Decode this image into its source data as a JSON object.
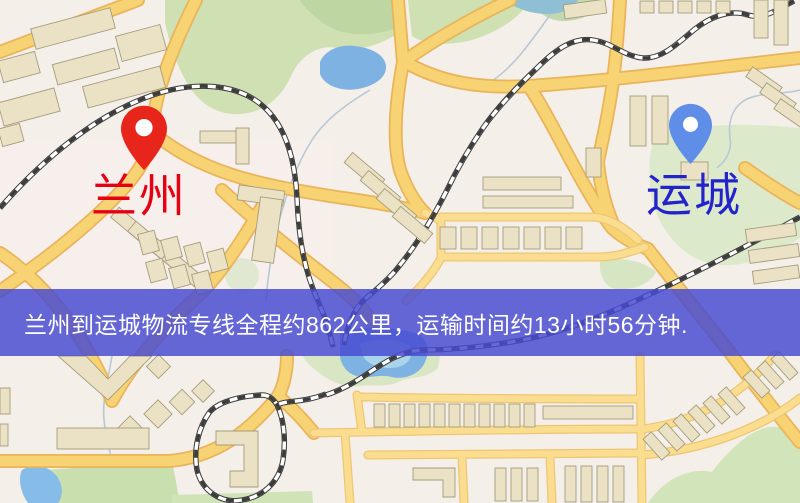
{
  "map": {
    "origin": {
      "label": "兰州",
      "pin_color": "#e8251b",
      "label_color": "#e60012"
    },
    "destination": {
      "label": "运城",
      "pin_color": "#5f8ee8",
      "label_color": "#2323cc"
    },
    "banner": {
      "text": "兰州到运城物流专线全程约862公里，运输时间约13小时56分钟.",
      "background_color": "rgba(72,75,210,0.84)",
      "text_color": "#ffffff",
      "distance_km": "862",
      "duration_hours": "13",
      "duration_minutes": "56"
    },
    "legend": {
      "road_color": "#f8d373",
      "water_color": "#7eb2e2",
      "park_color": "#cfe0b2",
      "building_color": "#ebe2c6"
    }
  }
}
